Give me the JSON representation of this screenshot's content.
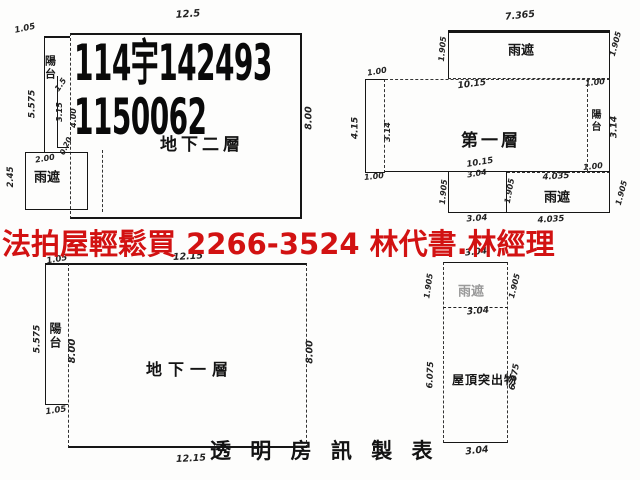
{
  "page": {
    "background": "#fdfdfc",
    "ink_color": "#161616"
  },
  "overlay": {
    "ad_text": "法拍屋輕鬆買  2266-3524  林代書.林經理",
    "color": "#d21212"
  },
  "credit": {
    "text": "透 明 房 訊 製 表"
  },
  "plans": {
    "basement2": {
      "stamp_line1": "114宇142493",
      "stamp_line2": "1150062",
      "floor_label": "地下二層"
    },
    "first": {
      "floor_label": "第一層"
    },
    "basement1": {
      "floor_label": "地下一層"
    },
    "roof": {
      "floor_label": "屋頂突出物"
    }
  },
  "annotations": [
    {
      "id": "b2-dim-top-width",
      "text": "12.5",
      "x": 188,
      "y": 15,
      "rot": -4,
      "size": 10
    },
    {
      "id": "b2-dim-topleft",
      "text": "1.05",
      "x": 25,
      "y": 29,
      "rot": -12,
      "size": 8.5
    },
    {
      "id": "b2-dim-left-height",
      "text": "5.575",
      "x": 33,
      "y": 104,
      "rot": -90,
      "size": 9
    },
    {
      "id": "b2-balcony-label",
      "text": "陽台",
      "x": 50,
      "y": 68,
      "vert": true,
      "cjk": true,
      "size": 11
    },
    {
      "id": "b2-dim-balcony",
      "text": "1.5",
      "x": 61,
      "y": 85,
      "rot": -55,
      "size": 8
    },
    {
      "id": "b2-dim-strip-1",
      "text": "3.15",
      "x": 60,
      "y": 112,
      "rot": -90,
      "size": 8
    },
    {
      "id": "b2-dim-strip-2",
      "text": "4.00",
      "x": 74,
      "y": 118,
      "rot": -90,
      "size": 8
    },
    {
      "id": "b2-dim-step",
      "text": "0.20",
      "x": 66,
      "y": 146,
      "rot": -65,
      "size": 7.5
    },
    {
      "id": "b2-dim-canopy-width",
      "text": "2.00",
      "x": 45,
      "y": 159,
      "rot": -10,
      "size": 8
    },
    {
      "id": "b2-canopy-label",
      "text": "雨遮",
      "x": 47,
      "y": 178,
      "cjk": true,
      "size": 13
    },
    {
      "id": "b2-dim-canopy-height",
      "text": "2.45",
      "x": 11,
      "y": 177,
      "rot": -90,
      "size": 8.5
    },
    {
      "id": "b2-dim-right-height",
      "text": "8.00",
      "x": 309,
      "y": 118,
      "rot": -90,
      "size": 9.5
    },
    {
      "id": "f1-dim-top-width",
      "text": "7.365",
      "x": 520,
      "y": 16,
      "rot": -6,
      "size": 9.5
    },
    {
      "id": "f1-canopy-top-label",
      "text": "雨遮",
      "x": 521,
      "y": 51,
      "cjk": true,
      "size": 13
    },
    {
      "id": "f1-dim-canopy-left",
      "text": "1.905",
      "x": 443,
      "y": 49,
      "rot": -85,
      "size": 8
    },
    {
      "id": "f1-dim-canopy-right",
      "text": "1.905",
      "x": 616,
      "y": 44,
      "rot": -75,
      "size": 8
    },
    {
      "id": "f1-dim-upper-width",
      "text": "10.15",
      "x": 472,
      "y": 85,
      "rot": -7,
      "size": 9
    },
    {
      "id": "f1-dim-nw",
      "text": "1.00",
      "x": 377,
      "y": 72,
      "rot": -10,
      "size": 8
    },
    {
      "id": "f1-dim-west-height",
      "text": "4.15",
      "x": 356,
      "y": 128,
      "rot": -90,
      "size": 9
    },
    {
      "id": "f1-dim-west-inner",
      "text": "3.14",
      "x": 388,
      "y": 132,
      "rot": -90,
      "size": 8
    },
    {
      "id": "f1-dim-sw",
      "text": "1.00",
      "x": 374,
      "y": 177,
      "rot": -6,
      "size": 8
    },
    {
      "id": "f1-dim-ne",
      "text": "1.00",
      "x": 595,
      "y": 83,
      "rot": -6,
      "size": 8
    },
    {
      "id": "f1-balcony-label",
      "text": "陽台",
      "x": 594,
      "y": 121,
      "vert": true,
      "cjk": true,
      "size": 10
    },
    {
      "id": "f1-dim-east-height",
      "text": "3.14",
      "x": 615,
      "y": 127,
      "rot": -90,
      "size": 9
    },
    {
      "id": "f1-dim-se",
      "text": "1.00",
      "x": 593,
      "y": 167,
      "rot": -6,
      "size": 8
    },
    {
      "id": "f1-dim-lower-width",
      "text": "10.15",
      "x": 480,
      "y": 163,
      "rot": -9,
      "size": 8.5
    },
    {
      "id": "f1-dim-lower-width2",
      "text": "3.04",
      "x": 477,
      "y": 174,
      "rot": -9,
      "size": 8
    },
    {
      "id": "f1-dim-bcanopy-left",
      "text": "1.905",
      "x": 444,
      "y": 192,
      "rot": -85,
      "size": 8
    },
    {
      "id": "f1-dim-bcanopy-mid",
      "text": "1.905",
      "x": 510,
      "y": 191,
      "rot": -80,
      "size": 8
    },
    {
      "id": "f1-dim-bcanopy-width",
      "text": "4.035",
      "x": 556,
      "y": 177,
      "rot": -4,
      "size": 8.5
    },
    {
      "id": "f1-bcanopy-label",
      "text": "雨遮",
      "x": 557,
      "y": 198,
      "cjk": true,
      "size": 13
    },
    {
      "id": "f1-dim-bcanopy-right",
      "text": "1.905",
      "x": 622,
      "y": 193,
      "rot": -75,
      "size": 8
    },
    {
      "id": "f1-dim-bottom-1",
      "text": "3.04",
      "x": 477,
      "y": 219,
      "rot": -4,
      "size": 8.5
    },
    {
      "id": "f1-dim-bottom-2",
      "text": "4.035",
      "x": 551,
      "y": 220,
      "rot": -4,
      "size": 8.5
    },
    {
      "id": "b1-dim-top-width",
      "text": "12.15",
      "x": 188,
      "y": 257,
      "rot": -3,
      "size": 9.5
    },
    {
      "id": "b1-dim-topleft",
      "text": "1.05",
      "x": 57,
      "y": 260,
      "rot": -10,
      "size": 8.5
    },
    {
      "id": "b1-dim-left-height",
      "text": "5.575",
      "x": 38,
      "y": 339,
      "rot": -90,
      "size": 9
    },
    {
      "id": "b1-balcony-label",
      "text": "陽台",
      "x": 55,
      "y": 336,
      "vert": true,
      "cjk": true,
      "size": 12
    },
    {
      "id": "b1-dim-inner-height",
      "text": "8.00",
      "x": 73,
      "y": 351,
      "rot": -90,
      "size": 10
    },
    {
      "id": "b1-dim-balcony-bottom",
      "text": "1.05",
      "x": 56,
      "y": 411,
      "rot": -8,
      "size": 8.5
    },
    {
      "id": "b1-dim-right-height",
      "text": "8.00",
      "x": 310,
      "y": 352,
      "rot": -90,
      "size": 9.5
    },
    {
      "id": "b1-dim-bottom-width",
      "text": "12.15",
      "x": 191,
      "y": 459,
      "rot": -3,
      "size": 9.5
    },
    {
      "id": "roof-dim-top-width",
      "text": "3.04",
      "x": 476,
      "y": 253,
      "rot": -6,
      "size": 9
    },
    {
      "id": "roof-canopy-label",
      "text": "雨遮",
      "x": 471,
      "y": 292,
      "cjk": true,
      "faint": true,
      "size": 13
    },
    {
      "id": "roof-dim-canopy-left",
      "text": "1.905",
      "x": 429,
      "y": 286,
      "rot": -82,
      "size": 8
    },
    {
      "id": "roof-dim-canopy-right",
      "text": "1.905",
      "x": 515,
      "y": 286,
      "rot": -76,
      "size": 8
    },
    {
      "id": "roof-dim-mid-width",
      "text": "3.04",
      "x": 478,
      "y": 312,
      "rot": -5,
      "size": 9
    },
    {
      "id": "roof-dim-left-height",
      "text": "6.075",
      "x": 431,
      "y": 375,
      "rot": -88,
      "size": 8.5
    },
    {
      "id": "roof-dim-right-height",
      "text": "6.075",
      "x": 515,
      "y": 377,
      "rot": -80,
      "size": 8.5
    },
    {
      "id": "roof-dim-bottom-width",
      "text": "3.04",
      "x": 477,
      "y": 451,
      "rot": -6,
      "size": 9.5
    }
  ]
}
